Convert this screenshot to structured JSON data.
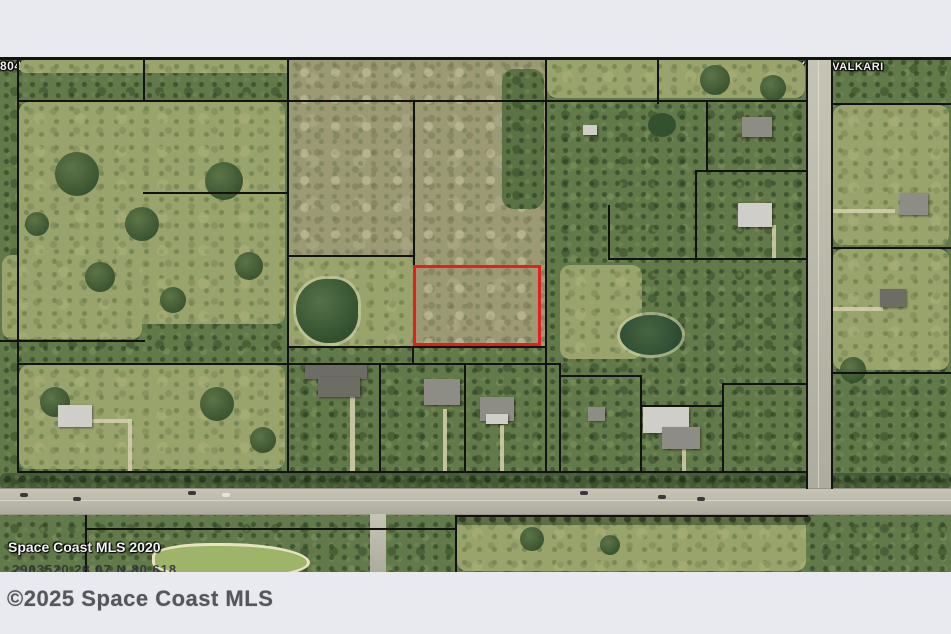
{
  "bars": {
    "copyright": "©2025 Space Coast MLS"
  },
  "map": {
    "watermark": "Space Coast MLS 2020",
    "footer_line": "2903520      28.07 N 80.618",
    "highlighted_parcel": "819",
    "highlight_color": "#e81e1e",
    "roads": {
      "vertical": "COREY RD",
      "horizontal": "VALKARI"
    },
    "parcels": [
      {
        "label": "804"
      },
      {
        "label": "774"
      },
      {
        "label": "825"
      },
      {
        "label": "832"
      },
      {
        "label": "758"
      },
      {
        "label": "545"
      },
      {
        "label": "766"
      },
      {
        "label": "809"
      },
      {
        "label": "801"
      },
      {
        "label": "759.2"
      },
      {
        "label": "759.3"
      },
      {
        "label": "587"
      },
      {
        "label": "775"
      },
      {
        "label": "835"
      },
      {
        "label": "812"
      },
      {
        "label": "759.1"
      },
      {
        "label": "772"
      },
      {
        "label": "787"
      },
      {
        "label": "819"
      },
      {
        "label": "754"
      },
      {
        "label": "585"
      },
      {
        "label": "760"
      },
      {
        "label": "771"
      },
      {
        "label": "726"
      },
      {
        "label": "724"
      },
      {
        "label": "778"
      },
      {
        "label": "844"
      },
      {
        "label": "780"
      }
    ]
  }
}
